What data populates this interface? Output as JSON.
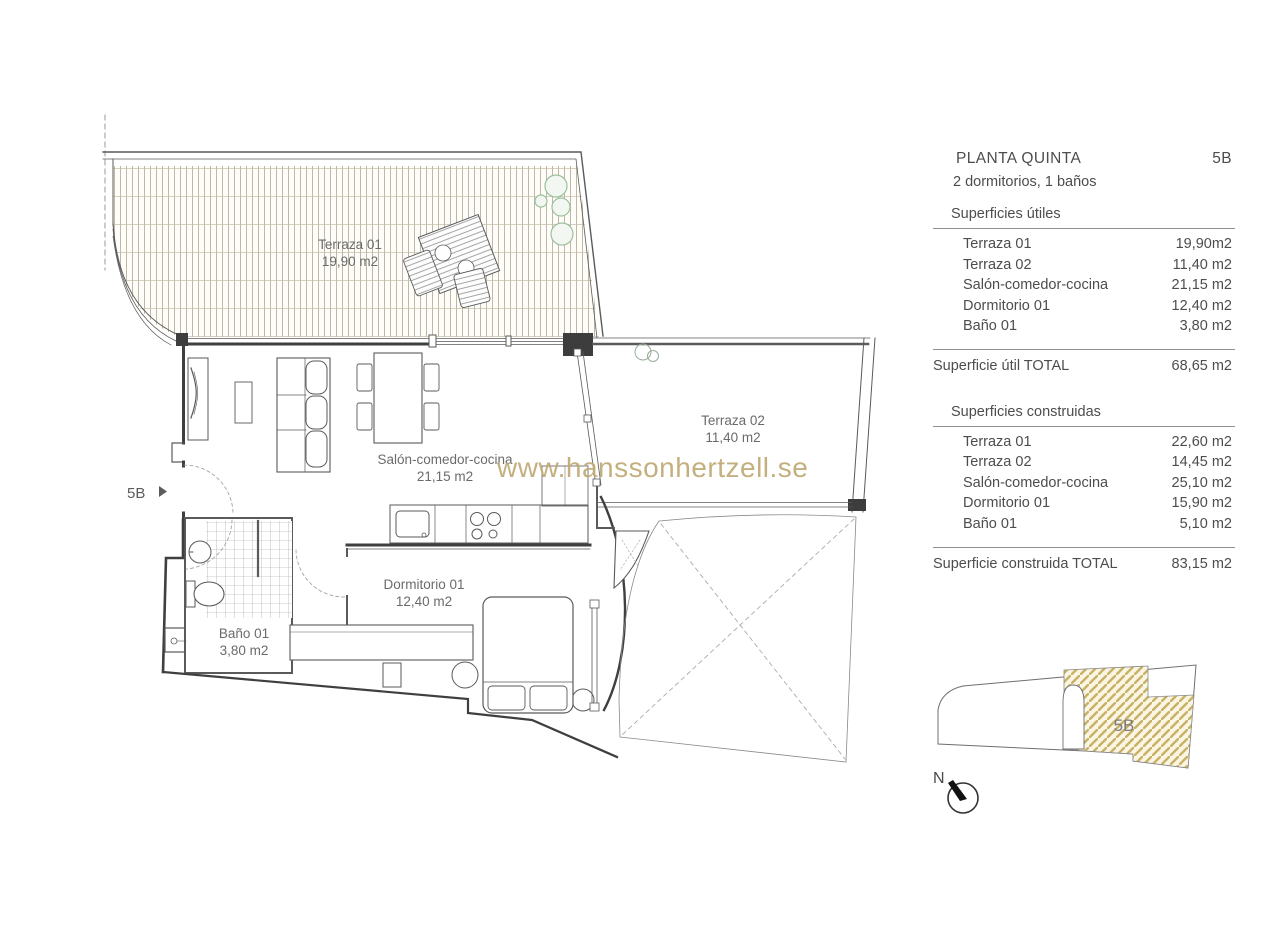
{
  "watermark": {
    "text": "www.hanssonhertzell.se",
    "color": "#bfa974"
  },
  "plan": {
    "entrance_label": "5B",
    "rooms": {
      "terraza1": {
        "name": "Terraza 01",
        "area": "19,90 m2"
      },
      "salon": {
        "name": "Salón-comedor-cocina",
        "area": "21,15 m2"
      },
      "terraza2": {
        "name": "Terraza 02",
        "area": "11,40 m2"
      },
      "dormitorio": {
        "name": "Dormitorio 01",
        "area": "12,40 m2"
      },
      "bano": {
        "name": "Baño 01",
        "area": "3,80 m2"
      }
    }
  },
  "panel": {
    "title": "PLANTA QUINTA",
    "unit": "5B",
    "subtitle": "2 dormitorios, 1 baños",
    "utiles": {
      "heading": "Superficies útiles",
      "rows": [
        {
          "label": "Terraza 01",
          "value": "19,90m2"
        },
        {
          "label": "Terraza 02",
          "value": "11,40 m2"
        },
        {
          "label": "Salón-comedor-cocina",
          "value": "21,15 m2"
        },
        {
          "label": "Dormitorio 01",
          "value": "12,40 m2"
        },
        {
          "label": "Baño 01",
          "value": "3,80 m2"
        }
      ],
      "total_label": "Superficie útil TOTAL",
      "total_value": "68,65 m2"
    },
    "construidas": {
      "heading": "Superficies  construidas",
      "rows": [
        {
          "label": "Terraza 01",
          "value": "22,60 m2"
        },
        {
          "label": "Terraza 02",
          "value": "14,45 m2"
        },
        {
          "label": "Salón-comedor-cocina",
          "value": "25,10 m2"
        },
        {
          "label": "Dormitorio 01",
          "value": "15,90 m2"
        },
        {
          "label": "Baño 01",
          "value": "5,10 m2"
        }
      ],
      "total_label": "Superficie construida TOTAL",
      "total_value": "83,15 m2"
    }
  },
  "locator": {
    "unit_label": "5B",
    "north_label": "N"
  },
  "colors": {
    "gold_hatch": "#c8b266",
    "deck_line": "#b8b098",
    "plant_green": "#9cbf9c",
    "wall": "#4a4a4a",
    "label_text": "#6b6b6b",
    "panel_text": "#4d4d4d"
  }
}
